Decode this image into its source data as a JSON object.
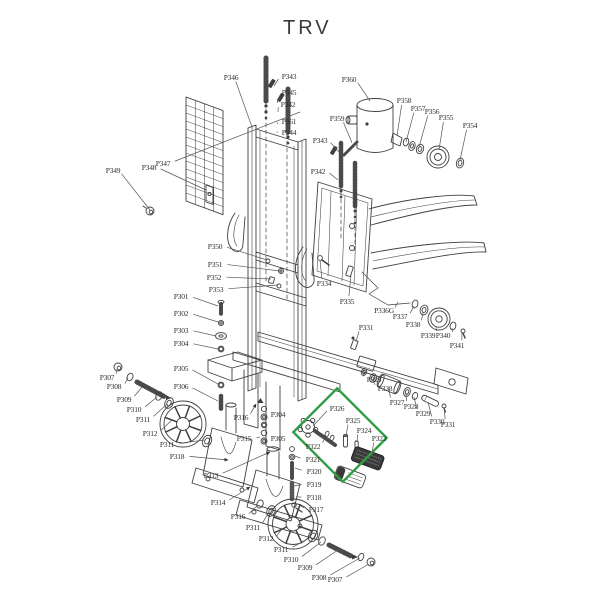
{
  "title": "TRV",
  "colors": {
    "line": "#3f3f3f",
    "leader": "#555555",
    "label_text": "#2e2e2e",
    "highlight": "#2f9e44",
    "rod": "#4a4a4a",
    "background": "#ffffff"
  },
  "highlight_box": {
    "cx": 340,
    "cy": 435,
    "width": 70,
    "height": 62,
    "rotation": 45
  },
  "labels": [
    {
      "text": "P346",
      "x": 231,
      "y": 80,
      "tx": 252,
      "ty": 127
    },
    {
      "text": "P343",
      "x": 289,
      "y": 79,
      "tx": 274,
      "ty": 86
    },
    {
      "text": "P345",
      "x": 289,
      "y": 95,
      "tx": 277,
      "ty": 103
    },
    {
      "text": "P342",
      "x": 288,
      "y": 107,
      "tx": 278,
      "ty": 112
    },
    {
      "text": "P361",
      "x": 289,
      "y": 124,
      "tx": 278,
      "ty": 124
    },
    {
      "text": "P344",
      "x": 289,
      "y": 135,
      "tx": 278,
      "ty": 132
    },
    {
      "text": "P349",
      "x": 113,
      "y": 173,
      "tx": 150,
      "ty": 210
    },
    {
      "text": "P348",
      "x": 149,
      "y": 170,
      "tx": 206,
      "ty": 190
    },
    {
      "text": "P347",
      "x": 163,
      "y": 166,
      "tx": 300,
      "ty": 112
    },
    {
      "text": "P343",
      "x": 320,
      "y": 143,
      "tx": 339,
      "ty": 152
    },
    {
      "text": "P342",
      "x": 318,
      "y": 174,
      "tx": 338,
      "ty": 180
    },
    {
      "text": "P360",
      "x": 349,
      "y": 82,
      "tx": 370,
      "ty": 101
    },
    {
      "text": "P359",
      "x": 337,
      "y": 121,
      "tx": 352,
      "ty": 143
    },
    {
      "text": "P358",
      "x": 404,
      "y": 103,
      "tx": 397,
      "ty": 136
    },
    {
      "text": "P357",
      "x": 418,
      "y": 111,
      "tx": 406,
      "ty": 142
    },
    {
      "text": "P356",
      "x": 432,
      "y": 114,
      "tx": 419,
      "ty": 147
    },
    {
      "text": "P355",
      "x": 446,
      "y": 120,
      "tx": 439,
      "ty": 150
    },
    {
      "text": "P354",
      "x": 470,
      "y": 128,
      "tx": 460,
      "ty": 160
    },
    {
      "text": "P350",
      "x": 215,
      "y": 249,
      "tx": 267,
      "ty": 260
    },
    {
      "text": "P351",
      "x": 215,
      "y": 267,
      "tx": 280,
      "ty": 271
    },
    {
      "text": "P352",
      "x": 214,
      "y": 280,
      "tx": 271,
      "ty": 279
    },
    {
      "text": "P353",
      "x": 216,
      "y": 292,
      "tx": 278,
      "ty": 285
    },
    {
      "text": "P334",
      "x": 324,
      "y": 286,
      "tx": 320,
      "ty": 260
    },
    {
      "text": "P335",
      "x": 347,
      "y": 304,
      "tx": 351,
      "ty": 275
    },
    {
      "text": "P336G",
      "x": 384,
      "y": 313,
      "tx": 398,
      "ty": 302
    },
    {
      "text": "P337",
      "x": 400,
      "y": 319,
      "tx": 414,
      "ty": 306
    },
    {
      "text": "P338",
      "x": 413,
      "y": 327,
      "tx": 423,
      "ty": 313
    },
    {
      "text": "P339",
      "x": 428,
      "y": 338,
      "tx": 436,
      "ty": 326
    },
    {
      "text": "P340",
      "x": 443,
      "y": 338,
      "tx": 452,
      "ty": 328
    },
    {
      "text": "P341",
      "x": 457,
      "y": 348,
      "tx": 462,
      "ty": 333
    },
    {
      "text": "P331",
      "x": 366,
      "y": 330,
      "tx": 356,
      "ty": 342
    },
    {
      "text": "P301",
      "x": 181,
      "y": 299,
      "tx": 218,
      "ty": 306
    },
    {
      "text": "P302",
      "x": 181,
      "y": 316,
      "tx": 218,
      "ty": 322
    },
    {
      "text": "P303",
      "x": 181,
      "y": 333,
      "tx": 216,
      "ty": 336
    },
    {
      "text": "P304",
      "x": 181,
      "y": 346,
      "tx": 218,
      "ty": 349
    },
    {
      "text": "P305",
      "x": 181,
      "y": 371,
      "tx": 218,
      "ty": 384
    },
    {
      "text": "P306",
      "x": 181,
      "y": 389,
      "tx": 218,
      "ty": 401
    },
    {
      "text": "P307",
      "x": 107,
      "y": 380,
      "tx": 116,
      "ty": 369
    },
    {
      "text": "P308",
      "x": 114,
      "y": 389,
      "tx": 128,
      "ty": 378
    },
    {
      "text": "P309",
      "x": 124,
      "y": 402,
      "tx": 142,
      "ty": 387
    },
    {
      "text": "P310",
      "x": 134,
      "y": 412,
      "tx": 157,
      "ty": 397
    },
    {
      "text": "P311",
      "x": 143,
      "y": 422,
      "tx": 167,
      "ty": 404
    },
    {
      "text": "P312",
      "x": 150,
      "y": 436,
      "tx": 172,
      "ty": 420
    },
    {
      "text": "P311",
      "x": 167,
      "y": 447,
      "tx": 204,
      "ty": 440
    },
    {
      "text": "P318",
      "x": 177,
      "y": 459,
      "tx": 228,
      "ty": 460,
      "arrow": true
    },
    {
      "text": "P313",
      "x": 211,
      "y": 478,
      "tx": 270,
      "ty": 452,
      "arrow": true
    },
    {
      "text": "P316",
      "x": 241,
      "y": 420,
      "tx": 256,
      "ty": 404,
      "arrow": true
    },
    {
      "text": "P304",
      "x": 278,
      "y": 417,
      "tx": 267,
      "ty": 417
    },
    {
      "text": "P315",
      "x": 244,
      "y": 441,
      "tx": 260,
      "ty": 437
    },
    {
      "text": "P305",
      "x": 278,
      "y": 441,
      "tx": 267,
      "ty": 441
    },
    {
      "text": "P326",
      "x": 337,
      "y": 411,
      "tx": 313,
      "ty": 426
    },
    {
      "text": "P325",
      "x": 353,
      "y": 423,
      "tx": 346,
      "ty": 436
    },
    {
      "text": "P324",
      "x": 364,
      "y": 433,
      "tx": 357,
      "ty": 442
    },
    {
      "text": "P323",
      "x": 379,
      "y": 441,
      "tx": 372,
      "ty": 453
    },
    {
      "text": "P322",
      "x": 313,
      "y": 449,
      "tx": 326,
      "ty": 435
    },
    {
      "text": "P321",
      "x": 313,
      "y": 462,
      "tx": 295,
      "ty": 456
    },
    {
      "text": "P320",
      "x": 314,
      "y": 474,
      "tx": 295,
      "ty": 468
    },
    {
      "text": "P319",
      "x": 314,
      "y": 487,
      "tx": 294,
      "ty": 486
    },
    {
      "text": "P318",
      "x": 314,
      "y": 500,
      "tx": 296,
      "ty": 497
    },
    {
      "text": "P317",
      "x": 316,
      "y": 512,
      "tx": 299,
      "ty": 505
    },
    {
      "text": "P314",
      "x": 218,
      "y": 505,
      "tx": 250,
      "ty": 487,
      "arrow": true
    },
    {
      "text": "P316",
      "x": 238,
      "y": 519,
      "tx": 258,
      "ty": 505
    },
    {
      "text": "P311",
      "x": 253,
      "y": 530,
      "tx": 269,
      "ty": 512
    },
    {
      "text": "P312",
      "x": 266,
      "y": 541,
      "tx": 281,
      "ty": 530
    },
    {
      "text": "P311",
      "x": 281,
      "y": 552,
      "tx": 311,
      "ty": 537
    },
    {
      "text": "P310",
      "x": 291,
      "y": 562,
      "tx": 321,
      "ty": 542
    },
    {
      "text": "P309",
      "x": 305,
      "y": 570,
      "tx": 338,
      "ty": 550
    },
    {
      "text": "P308",
      "x": 319,
      "y": 580,
      "tx": 360,
      "ty": 558
    },
    {
      "text": "P307",
      "x": 335,
      "y": 582,
      "tx": 369,
      "ty": 564
    },
    {
      "text": "P329",
      "x": 374,
      "y": 382,
      "tx": 364,
      "ty": 373
    },
    {
      "text": "P328",
      "x": 385,
      "y": 391,
      "tx": 373,
      "ty": 379
    },
    {
      "text": "P327",
      "x": 397,
      "y": 405,
      "tx": 388,
      "ty": 387
    },
    {
      "text": "P328",
      "x": 411,
      "y": 409,
      "tx": 406,
      "ty": 393
    },
    {
      "text": "P329",
      "x": 423,
      "y": 416,
      "tx": 414,
      "ty": 397
    },
    {
      "text": "P330",
      "x": 437,
      "y": 424,
      "tx": 428,
      "ty": 402
    },
    {
      "text": "P331",
      "x": 448,
      "y": 427,
      "tx": 444,
      "ty": 407
    }
  ]
}
